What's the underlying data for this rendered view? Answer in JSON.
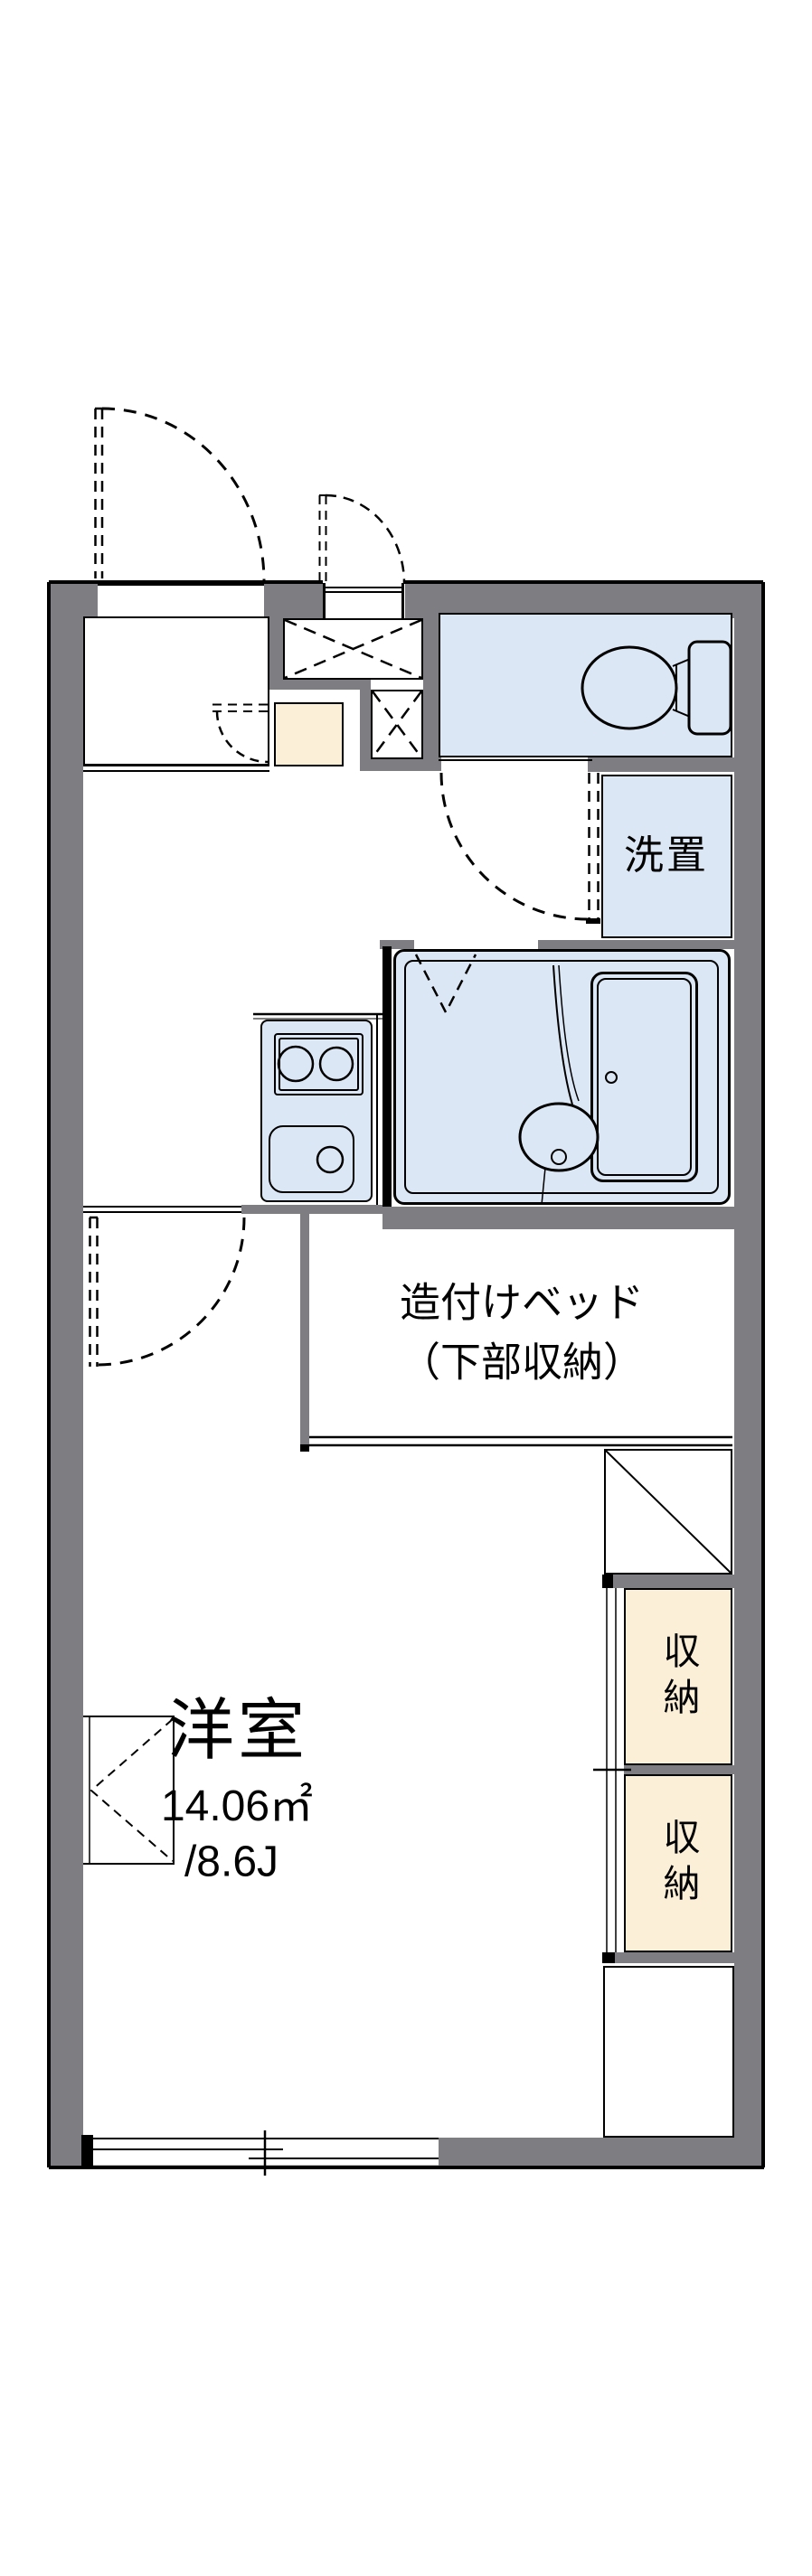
{
  "meta": {
    "type": "apartment-floor-plan"
  },
  "labels": {
    "washer": "洗置",
    "bed_line1": "造付けベッド",
    "bed_line2": "（下部収納）",
    "room_name": "洋室",
    "room_area": "14.06㎡",
    "room_jo": "/8.6J",
    "closet_upper": "収納",
    "closet_lower": "収納"
  },
  "colors": {
    "wall_gray": "#7e7e82",
    "water_room_blue": "#dce7f6",
    "closet_cream": "#fcefd8",
    "line_black": "#000000",
    "background": "#ffffff"
  }
}
